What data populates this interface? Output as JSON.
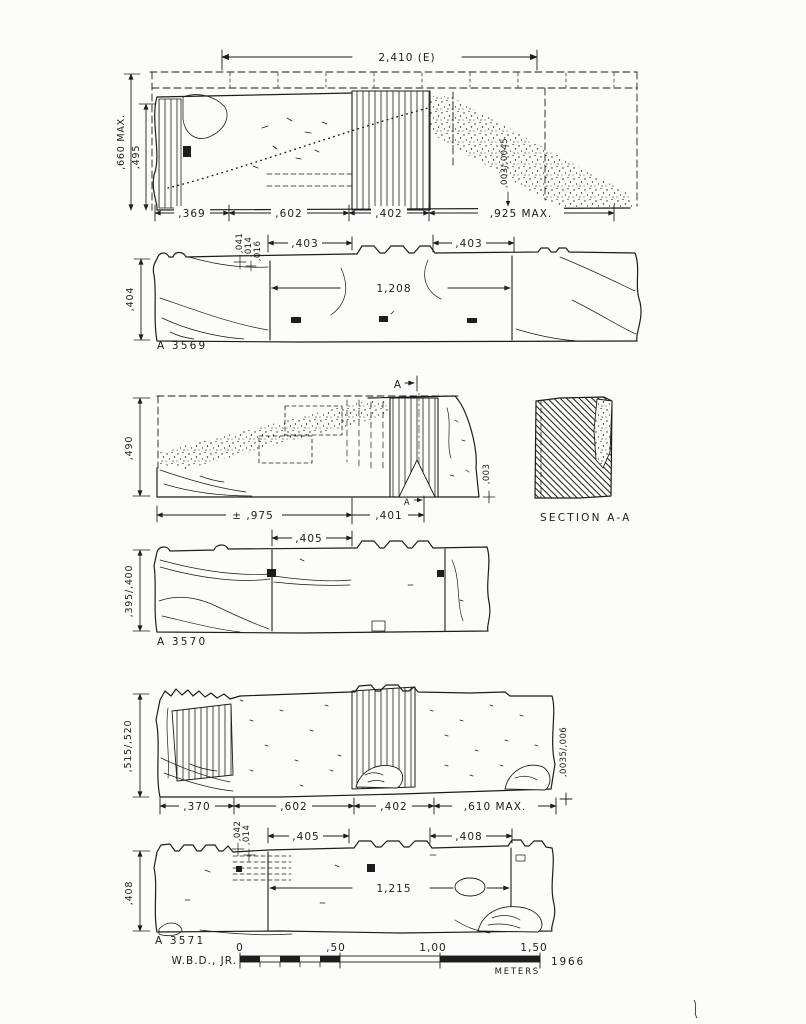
{
  "colors": {
    "paper": "#fcfcfa",
    "ink": "#1d1d1d"
  },
  "a3569": {
    "elevation": {
      "width_total": "2,410 (E)",
      "height_max": ",660 MAX.",
      "height": ",495",
      "offset_note": ",003/,0045",
      "bottom_dims": [
        ",369",
        ",602",
        ",402",
        ",925 MAX."
      ]
    },
    "plan": {
      "label": "A 3569",
      "edge_dims": [
        ",041",
        ",014",
        ",016"
      ],
      "top_dims": [
        ",403",
        ",403"
      ],
      "side_dim": ",404",
      "length_dim": "1,208"
    }
  },
  "a3570": {
    "elevation": {
      "section_letter": "A",
      "side_dim": ",490",
      "bottom_dims": [
        "± ,975",
        ",401"
      ],
      "offset_note": ",003"
    },
    "section_label": "SECTION A-A",
    "plan": {
      "label": "A 3570",
      "top_dim": ",405",
      "side_dim": ",395/,400"
    }
  },
  "a3571": {
    "elevation": {
      "side_dim": ",515/,520",
      "bottom_dims": [
        ",370",
        ",602",
        ",402",
        ",610 MAX."
      ],
      "offset_note": ",0035/,006"
    },
    "plan": {
      "label": "A 3571",
      "edge_dims": [
        ",042",
        ",014"
      ],
      "top_dims": [
        ",405",
        ",408"
      ],
      "side_dim": ",408",
      "length_dim": "1,215"
    }
  },
  "title_block": {
    "author": "W.B.D., JR.",
    "scale_ticks": [
      "0",
      ",50",
      "1,00",
      "1,50"
    ],
    "unit": "METERS",
    "year": "1966"
  }
}
